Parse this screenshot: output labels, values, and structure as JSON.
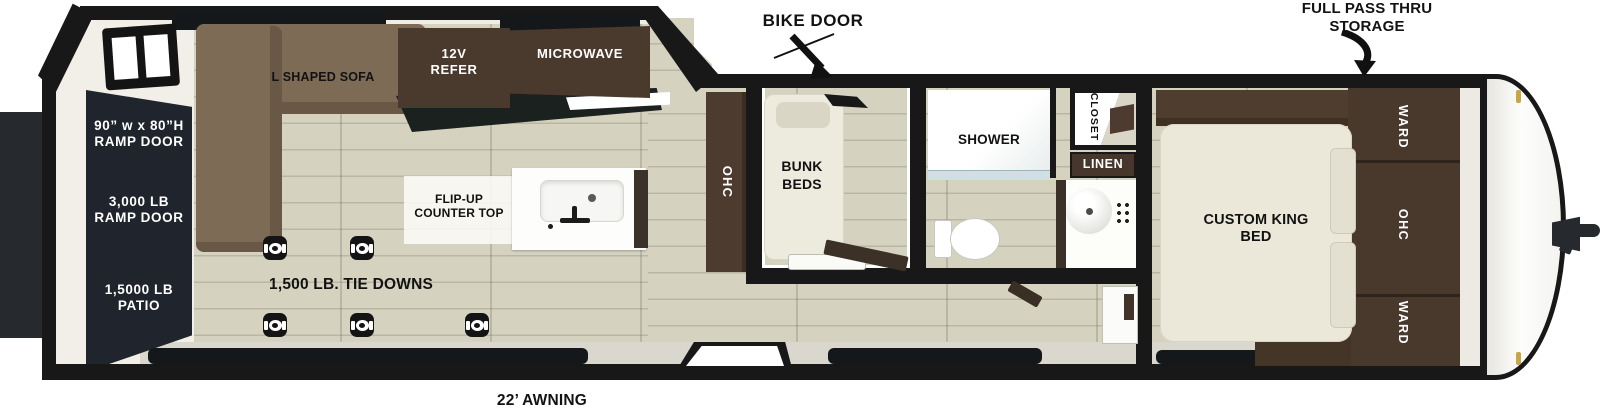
{
  "title": "Toy hauler travel trailer floorplan",
  "colors": {
    "wall": "#181818",
    "floor": "#d5d2c0",
    "cabinet_brown": "#4a392d",
    "sofa_brown": "#7e6b56",
    "mattress_cream": "#ebe8da",
    "ramp_door_dark": "#20242c",
    "patio_dark": "#26292d"
  },
  "callouts": {
    "bike_door": "BIKE DOOR",
    "full_pass_thru": "FULL PASS THRU\nSTORAGE",
    "tie_downs": "1,500 LB. TIE DOWNS",
    "awning": "22’ AWNING"
  },
  "garage": {
    "ramp_door_size": "90” w x 80”H\nRAMP DOOR",
    "ramp_door_weight": "3,000 LB\nRAMP DOOR",
    "patio": "1,5000 LB\nPATIO",
    "sofa": "L SHAPED SOFA",
    "refer": "12V\nREFER",
    "microwave": "MICROWAVE",
    "flip_up_counter": "FLIP-UP\nCOUNTER TOP",
    "ohc": "OHC"
  },
  "bunk_room": {
    "bunk_beds": "BUNK\nBEDS"
  },
  "bathroom": {
    "shower": "SHOWER",
    "closet": "CLOSET",
    "linen": "LINEN"
  },
  "bedroom": {
    "bed": "CUSTOM KING\nBED",
    "ward_top": "WARD",
    "ohc": "OHC",
    "ward_bottom": "WARD"
  }
}
